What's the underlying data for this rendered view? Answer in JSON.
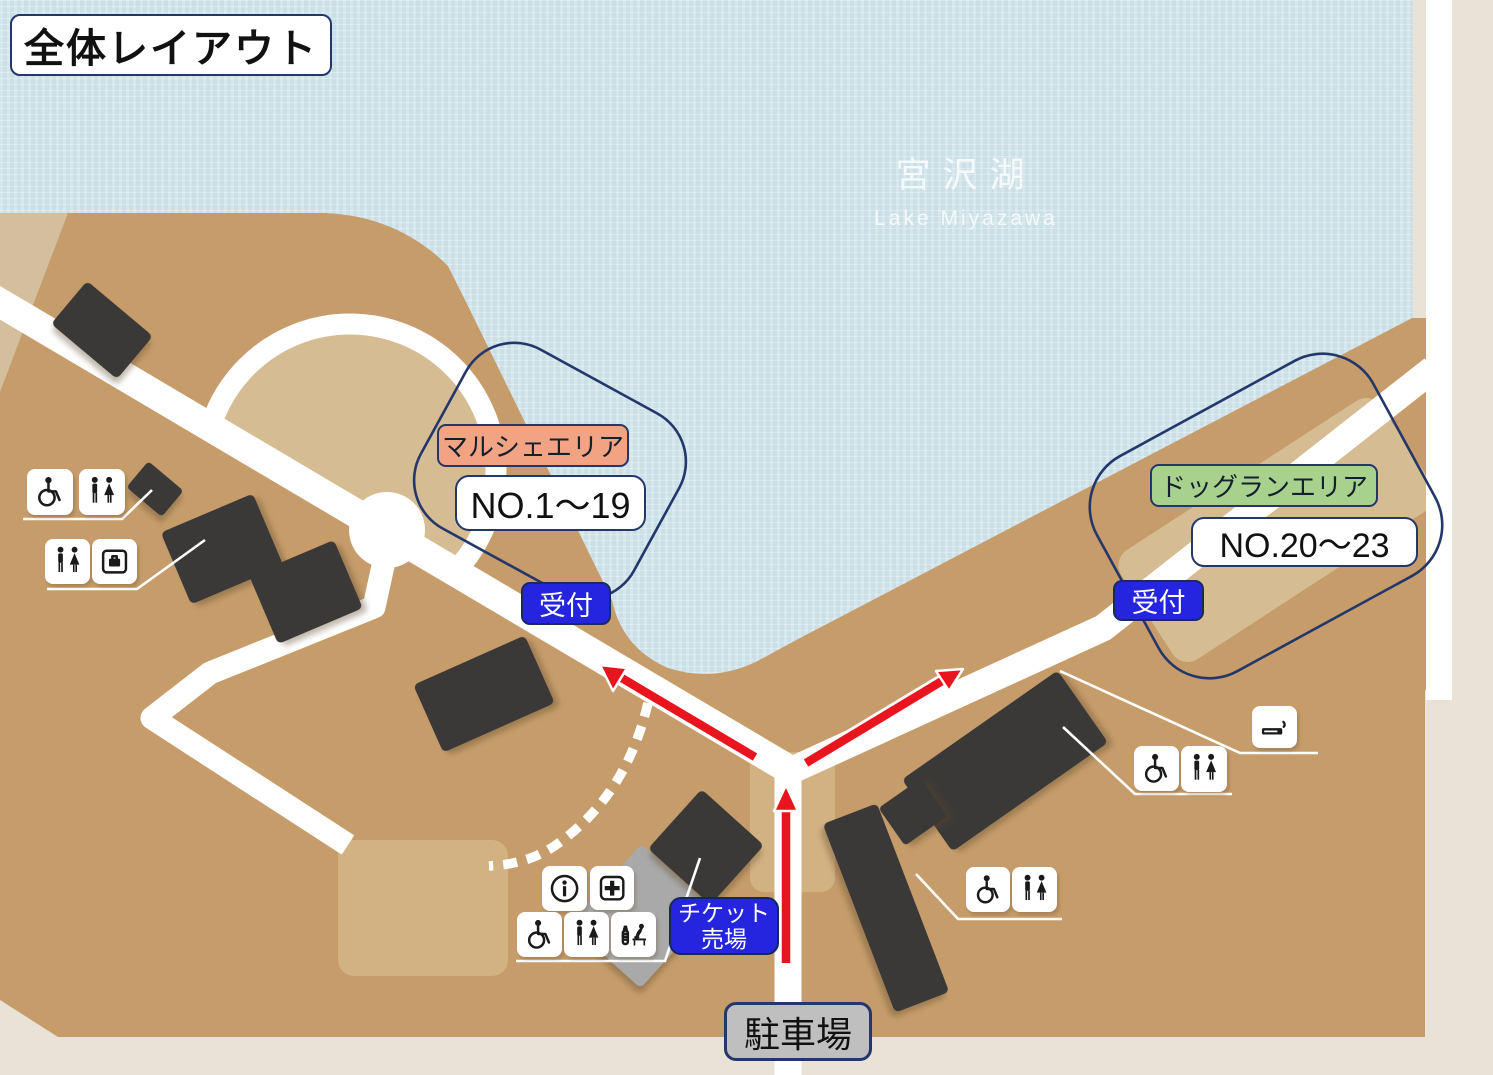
{
  "title": "全体レイアウト",
  "lake": {
    "name_ja": "宮沢湖",
    "name_en": "Lake Miyazawa"
  },
  "areas": {
    "marche": {
      "label": "マルシェエリア",
      "range": "NO.1～19",
      "reception": "受付"
    },
    "dogrun": {
      "label": "ドッグランエリア",
      "range": "NO.20～23",
      "reception": "受付"
    }
  },
  "facilities": {
    "ticket_office": {
      "line1": "チケット",
      "line2": "売場"
    },
    "parking": "駐車場"
  },
  "icons": {
    "northwest_group_upper": [
      "wheelchair-icon",
      "restroom-icon"
    ],
    "northwest_group_lower": [
      "restroom-icon",
      "coin-locker-icon"
    ],
    "ticket_gate_group": [
      "information-icon",
      "first-aid-icon",
      "wheelchair-icon",
      "restroom-icon",
      "baby-care-icon"
    ],
    "dogrun_entrance_group": [
      "smoking-area-icon",
      "wheelchair-icon",
      "restroom-icon"
    ],
    "south_group": [
      "wheelchair-icon",
      "restroom-icon"
    ]
  },
  "colors": {
    "lake": "#CBDFE7",
    "land": "#C69C6B",
    "land_light": "#D3BE9E",
    "field_light": "#D6BC93",
    "plaza": "#D2B183",
    "outside_beige": "#E8E3D6",
    "road": "#FFFFFF",
    "navy_outline": "#24376B",
    "reception_blue": "#2525DF",
    "marche_salmon": "#F2A383",
    "dogrun_green": "#A9D18E",
    "parking_gray": "#BFBFBF",
    "building_dark": "#3B3938",
    "arrow_red": "#E8141E"
  }
}
